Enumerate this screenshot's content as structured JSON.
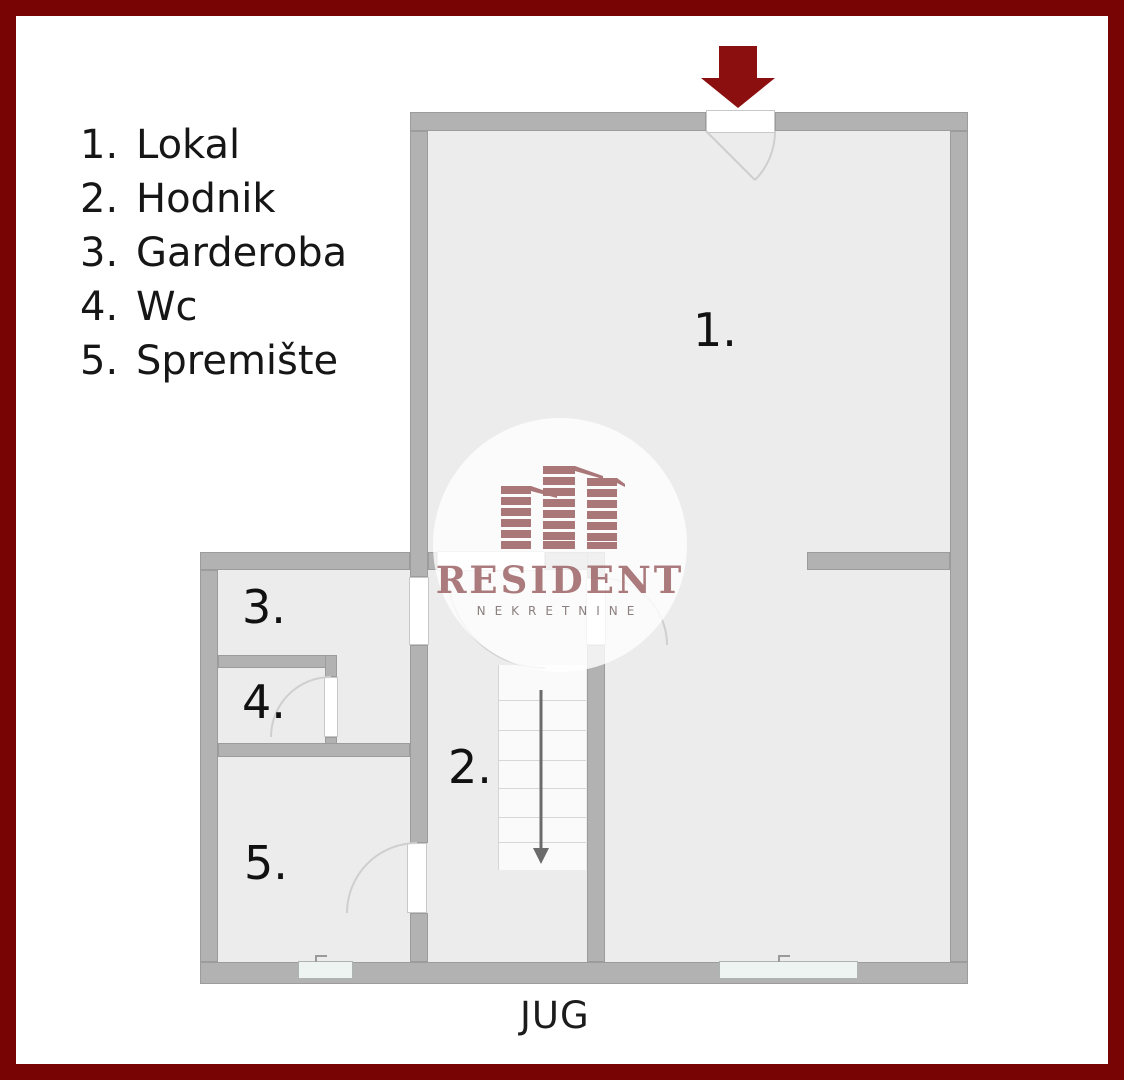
{
  "rooms": [
    {
      "num": "1.",
      "name": "Lokal"
    },
    {
      "num": "2.",
      "name": "Hodnik"
    },
    {
      "num": "3.",
      "name": "Garderoba"
    },
    {
      "num": "4.",
      "name": "Wc"
    },
    {
      "num": "5.",
      "name": "Spremište"
    }
  ],
  "compass": {
    "south": "JUG"
  },
  "watermark": {
    "brand": "RESIDENT",
    "tagline": "NEKRETNINE"
  },
  "icons": {
    "entrance": "down-arrow-icon",
    "stairs_direction": "down-arrow-icon",
    "logo": "buildings-icon"
  },
  "colors": {
    "border_red": "#780404",
    "arrow_red": "#8b0f0f",
    "wall_gray": "#b2b2b2",
    "floor_gray": "#ececec",
    "logo_red": "#9d6163",
    "text_dark": "#161616"
  }
}
